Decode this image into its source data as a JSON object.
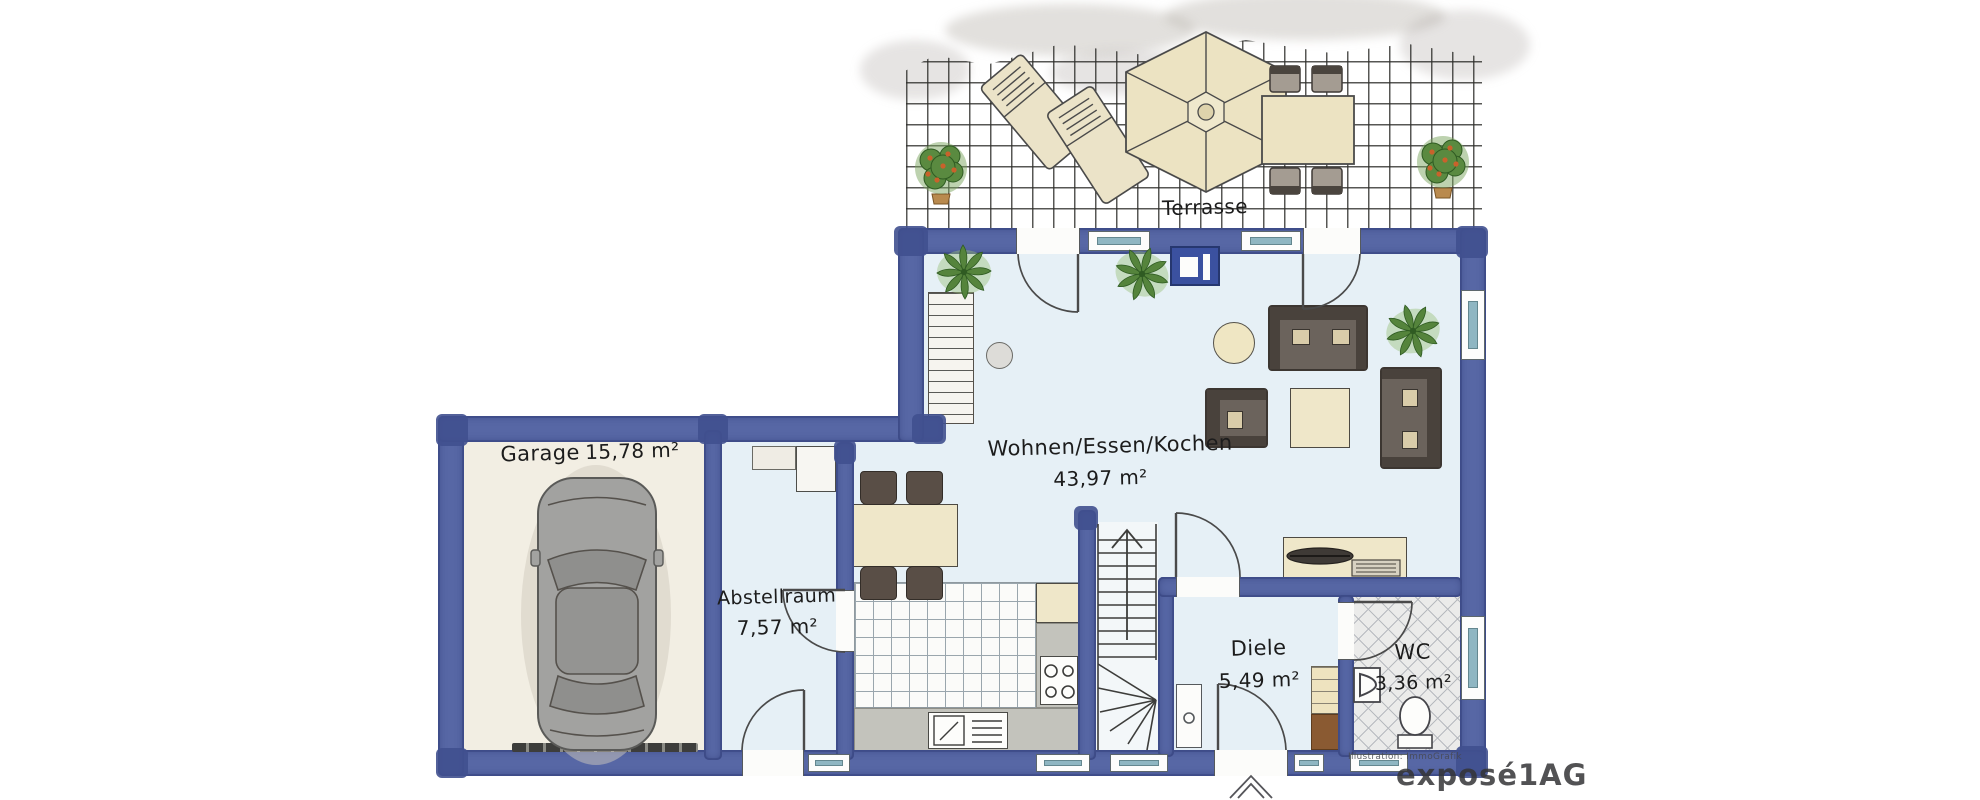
{
  "watermark": {
    "brand": "exposé1AG",
    "credit": "Illustration: ImmoGrafik"
  },
  "rooms": {
    "terrasse": {
      "label": "Terrasse"
    },
    "wohnen": {
      "label": "Wohnen/Essen/Kochen",
      "area": "43,97 m²"
    },
    "garage": {
      "label": "Garage",
      "area": "15,78 m²"
    },
    "abstellraum": {
      "label": "Abstellraum",
      "area": "7,57 m²"
    },
    "diele": {
      "label": "Diele",
      "area": "5,49 m²"
    },
    "wc": {
      "label": "WC",
      "area": "3,36 m²"
    }
  },
  "colors": {
    "wall_blue": "#5767a5",
    "wall_blue_dark": "#40508f",
    "window_teal": "#8fb6c2",
    "floor_blue": "#e6f0f6",
    "garage_floor": "#f2eee3",
    "beige": "#ece3c2",
    "furniture_dark": "#6b635c",
    "plant_green": "#55843c"
  }
}
